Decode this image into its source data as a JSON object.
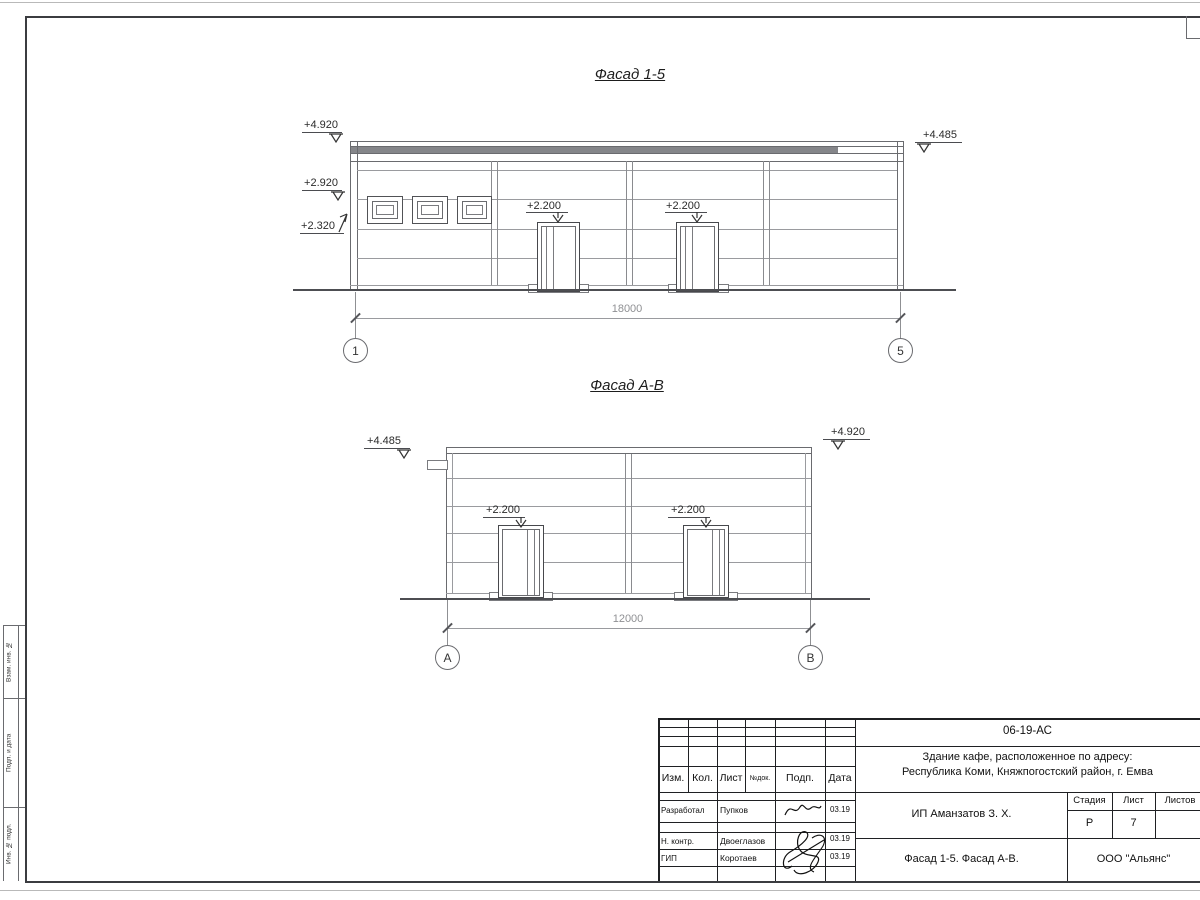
{
  "facade15": {
    "title": "Фасад 1-5",
    "mark_left_top": "+4.920",
    "mark_left_mid": "+2.920",
    "mark_left_bottom": "+2.320",
    "mark_right": "+4.485",
    "mark_door1": "+2.200",
    "mark_door2": "+2.200",
    "dimension": "18000",
    "axis_left": "1",
    "axis_right": "5"
  },
  "facadeAB": {
    "title": "Фасад А-В",
    "mark_left": "+4.485",
    "mark_right": "+4.920",
    "mark_door1": "+2.200",
    "mark_door2": "+2.200",
    "dimension": "12000",
    "axis_left": "А",
    "axis_right": "В"
  },
  "side_stamp": {
    "top": "Взам. инв. №",
    "middle": "Подп. и дата",
    "bottom": "Инв. № подл."
  },
  "title_block": {
    "doc_number": "06-19-АС",
    "project_address_line1": "Здание кафе, расположенное по адресу:",
    "project_address_line2": "Республика Коми, Княжпогостский район, г. Емва",
    "col_izm": "Изм.",
    "col_kol": "Кол.",
    "col_list": "Лист",
    "col_ndok": "№док.",
    "col_podp": "Подп.",
    "col_data": "Дата",
    "row_developed_role": "Разработал",
    "row_developed_name": "Пупков",
    "row_developed_date": "03.19",
    "row_ncontr_role": "Н. контр.",
    "row_ncontr_name": "Двоеглазов",
    "row_ncontr_date": "03.19",
    "row_gip_role": "ГИП",
    "row_gip_name": "Коротаев",
    "row_gip_date": "03.19",
    "client": "ИП Аманзатов З. Х.",
    "stage_label": "Стадия",
    "sheet_label": "Лист",
    "sheets_label": "Листов",
    "stage_value": "Р",
    "sheet_value": "7",
    "sheets_value": "",
    "sheet_title": "Фасад 1-5. Фасад А-В.",
    "company": "ООО \"Альянс\""
  }
}
